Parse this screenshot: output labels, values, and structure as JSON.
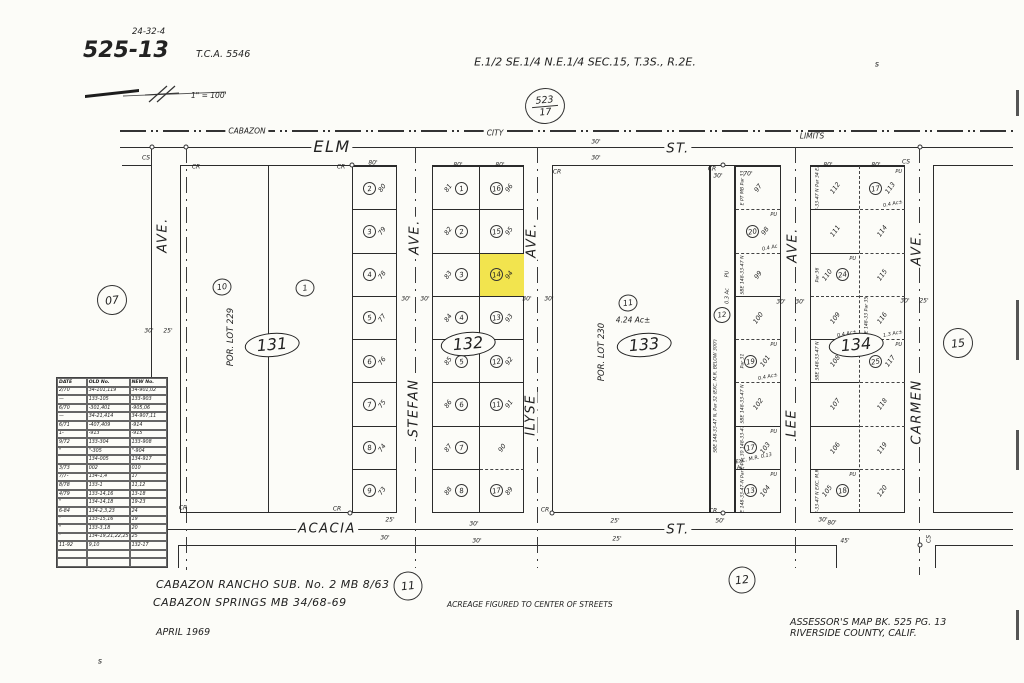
{
  "page": {
    "map_ref": "24-32-4",
    "book_page": "525-13",
    "tca": "T.C.A. 5546",
    "title": "E.1/2 SE.1/4 N.E.1/4  SEC.15, T.3S., R.2E.",
    "scale_label": "1\" = 100'",
    "adjacent_ref_top": {
      "num": "523",
      "den": "17"
    }
  },
  "city_limits": {
    "left": "CABAZON",
    "mid": "CITY",
    "right": "LIMITS"
  },
  "streets": {
    "elm": {
      "name": "ELM",
      "suffix": "ST."
    },
    "acacia": {
      "name": "ACACIA",
      "suffix": "ST."
    },
    "bonita": {
      "name": "BONITA",
      "suffix": "AVE."
    },
    "stefan": {
      "name": "STEFAN",
      "suffix": "AVE."
    },
    "ilyse": {
      "name": "ILYSE",
      "suffix": "AVE."
    },
    "lee": {
      "name": "LEE",
      "suffix": "AVE."
    },
    "carmen": {
      "name": "CARMEN",
      "suffix": "AVE."
    }
  },
  "adjacent_pages": [
    {
      "label": "07",
      "x": 112,
      "y": 300,
      "d": 30
    },
    {
      "label": "15",
      "x": 958,
      "y": 343,
      "d": 30
    },
    {
      "label": "11",
      "x": 408,
      "y": 586,
      "d": 29
    },
    {
      "label": "12",
      "x": 742,
      "y": 580,
      "d": 27
    }
  ],
  "blocks": {
    "b131": {
      "label": "131",
      "por": "POR. LOT 229",
      "main": [
        {
          "circle": "10"
        },
        {
          "circle": "1"
        }
      ],
      "strip": [
        {
          "circle": "2",
          "lot": "80"
        },
        {
          "circle": "3",
          "lot": "79"
        },
        {
          "circle": "4",
          "lot": "78"
        },
        {
          "circle": "5",
          "lot": "77"
        },
        {
          "circle": "6",
          "lot": "76"
        },
        {
          "circle": "7",
          "lot": "75"
        },
        {
          "circle": "8",
          "lot": "74"
        },
        {
          "circle": "9",
          "lot": "73"
        }
      ]
    },
    "b132": {
      "label": "132",
      "west": [
        {
          "circle": "1",
          "lot": "81"
        },
        {
          "circle": "2",
          "lot": "82"
        },
        {
          "circle": "3",
          "lot": "83"
        },
        {
          "circle": "4",
          "lot": "84"
        },
        {
          "circle": "5",
          "lot": "85"
        },
        {
          "circle": "6",
          "lot": "86"
        },
        {
          "circle": "7",
          "lot": "87"
        },
        {
          "circle": "8",
          "lot": "88"
        }
      ],
      "east": [
        {
          "circle": "16",
          "lot": "96"
        },
        {
          "circle": "15",
          "lot": "95"
        },
        {
          "circle": "14",
          "lot": "94",
          "highlight": true
        },
        {
          "circle": "13",
          "lot": "93"
        },
        {
          "circle": "12",
          "lot": "92"
        },
        {
          "circle": "11",
          "lot": "91"
        },
        {
          "lot": "90"
        },
        {
          "circle": "17",
          "lot": "89",
          "dash_top": true
        }
      ]
    },
    "b133": {
      "label": "133",
      "por": "POR. LOT 230",
      "circle": "11",
      "acreage": "4.24 Ac±",
      "strip": {
        "circle": "12",
        "pu": "PU",
        "ac": "0.3 Ac",
        "note": "SBE 148-33-47 N, Par 32 (EXC. M.R. BELOW 300')"
      },
      "lee_col": [
        {
          "lot": "97",
          "note": "E PT MB Par 33"
        },
        {
          "circle": "20",
          "lot": "98",
          "pu": "PU",
          "ac": "0.4 Ac",
          "dash_top": true
        },
        {
          "lot": "99",
          "note": "SBE 148-33-47 N",
          "dash_top": true
        },
        {
          "lot": "100"
        },
        {
          "circle": "19",
          "lot": "101",
          "pu": "PU",
          "ac": "0.4 Ac±",
          "note": "Par 31",
          "dash_top": true
        },
        {
          "lot": "102",
          "note": "SBE 148-33-47 N",
          "dash_top": true
        },
        {
          "circle": "17",
          "lot": "103",
          "pu": "PU",
          "note": "SBE Par 30 148-33-47 N",
          "ac": "EXC. M.R. 0.13 Ac."
        },
        {
          "circle": "13",
          "lot": "104",
          "pu": "PU",
          "note": "SBE 148-33-47-N Par 29"
        }
      ]
    },
    "b134": {
      "label": "134",
      "west": [
        {
          "lot": "112",
          "note": "SBE 148-33-47 N Par 34 EXC. M.R."
        },
        {
          "lot": "111"
        },
        {
          "circle": "24",
          "lot": "110",
          "pu": "PU",
          "note": "Par 36"
        },
        {
          "lot": "109",
          "ac": "0.4 Ac±",
          "dash_top": true
        },
        {
          "lot": "108",
          "note": "SBE 148-33-47 N"
        },
        {
          "lot": "107"
        },
        {
          "lot": "106"
        },
        {
          "circle": "18",
          "lot": "105",
          "pu": "PU",
          "note": "SBE 148-33-47 N EXC. M.R. Par 28"
        }
      ],
      "east": [
        {
          "circle": "17",
          "lot": "113",
          "pu": "PU",
          "ac": "0.4 Ac±"
        },
        {
          "lot": "114",
          "dash_top": true
        },
        {
          "lot": "115",
          "dash_top": true
        },
        {
          "lot": "116",
          "ac": "1.3 Ac±",
          "note": "SBE 148-33 Par 35",
          "dash_top": true
        },
        {
          "circle": "25",
          "lot": "117",
          "pu": "PU",
          "dash_top": true
        },
        {
          "lot": "118",
          "dash_top": true
        },
        {
          "lot": "119",
          "dash_top": true
        },
        {
          "lot": "120",
          "dash_top": true
        }
      ]
    }
  },
  "revision_table": {
    "headers": [
      "DATE",
      "OLD No.",
      "NEW No."
    ],
    "rows": [
      [
        "2/70",
        "34-101,119",
        "34-901,02"
      ],
      [
        "—",
        "133-105",
        "133-903"
      ],
      [
        "6/70",
        "-301,401",
        "-905,06"
      ],
      [
        "—",
        "34-21,414",
        "34-907,11"
      ],
      [
        "6/71",
        "-407,409",
        "-914"
      ],
      [
        "1-",
        "-913",
        "-915"
      ],
      [
        "9/72",
        "133-304",
        "133-908"
      ],
      [
        "\"",
        "\"-305",
        "\"-904"
      ],
      [
        "",
        "134-005",
        "134-917"
      ],
      [
        "3/73",
        "002",
        "010"
      ],
      [
        "7/7-",
        "134-1,4",
        "17"
      ],
      [
        "8/78",
        "133-1",
        "11,12"
      ],
      [
        "4/79",
        "133-14,16",
        "13-18"
      ],
      [
        "\"",
        "134-14,18",
        "19-23"
      ],
      [
        "6-84",
        "134-2,3,23",
        "24"
      ],
      [
        "\"",
        "133-15,16",
        "19"
      ],
      [
        "\"",
        "133-3,18",
        "20"
      ],
      [
        "\"",
        "134-19,21,22,25",
        "25"
      ],
      [
        "11-92",
        "9,10",
        "132-17"
      ],
      [
        "",
        "",
        ""
      ],
      [
        "",
        "",
        ""
      ]
    ]
  },
  "footer": {
    "sub_note1": "CABAZON  RANCHO  SUB.  No. 2  MB 8/63",
    "sub_note2": "CABAZON  SPRINGS  MB 34/68-69",
    "date": "APRIL  1969",
    "acreage_note": "ACREAGE   FIGURED   TO   CENTER   OF   STREETS",
    "assessor_line1": "ASSESSOR'S   MAP   BK. 525   PG. 13",
    "assessor_line2": "RIVERSIDE    COUNTY,   CALIF."
  },
  "corner_markers": [
    {
      "t": "CS",
      "x": 146,
      "y": 158
    },
    {
      "t": "CR",
      "x": 196,
      "y": 167
    },
    {
      "t": "CR",
      "x": 341,
      "y": 167
    },
    {
      "t": "CR",
      "x": 557,
      "y": 172
    },
    {
      "t": "CR",
      "x": 712,
      "y": 169
    },
    {
      "t": "CS",
      "x": 906,
      "y": 162
    },
    {
      "t": "CR",
      "x": 183,
      "y": 508
    },
    {
      "t": "CR",
      "x": 337,
      "y": 509
    },
    {
      "t": "CR",
      "x": 545,
      "y": 510
    },
    {
      "t": "CR",
      "x": 713,
      "y": 511
    },
    {
      "t": "CS",
      "x": 929,
      "y": 539,
      "rot": -90
    }
  ],
  "dims": [
    {
      "t": "30'",
      "x": 596,
      "y": 142
    },
    {
      "t": "30'",
      "x": 596,
      "y": 158
    },
    {
      "t": "80'",
      "x": 373,
      "y": 163
    },
    {
      "t": "80'",
      "x": 458,
      "y": 165
    },
    {
      "t": "80'",
      "x": 500,
      "y": 165
    },
    {
      "t": "80'",
      "x": 828,
      "y": 165
    },
    {
      "t": "80'",
      "x": 876,
      "y": 165
    },
    {
      "t": "30'",
      "x": 149,
      "y": 331
    },
    {
      "t": "25'",
      "x": 168,
      "y": 331
    },
    {
      "t": "30'",
      "x": 406,
      "y": 299
    },
    {
      "t": "30'",
      "x": 425,
      "y": 299
    },
    {
      "t": "30'",
      "x": 527,
      "y": 299
    },
    {
      "t": "30'",
      "x": 549,
      "y": 299
    },
    {
      "t": "30'",
      "x": 781,
      "y": 302
    },
    {
      "t": "30'",
      "x": 800,
      "y": 302
    },
    {
      "t": "30'",
      "x": 905,
      "y": 301
    },
    {
      "t": "25'",
      "x": 924,
      "y": 301
    },
    {
      "t": "25'",
      "x": 390,
      "y": 520
    },
    {
      "t": "30'",
      "x": 385,
      "y": 538
    },
    {
      "t": "30'",
      "x": 474,
      "y": 524
    },
    {
      "t": "30'",
      "x": 477,
      "y": 541
    },
    {
      "t": "25'",
      "x": 615,
      "y": 521
    },
    {
      "t": "25'",
      "x": 617,
      "y": 539
    },
    {
      "t": "30'",
      "x": 823,
      "y": 520
    },
    {
      "t": "45'",
      "x": 845,
      "y": 541
    },
    {
      "t": "50'",
      "x": 720,
      "y": 521
    },
    {
      "t": "80'",
      "x": 832,
      "y": 523
    },
    {
      "t": "30'",
      "x": 718,
      "y": 176
    },
    {
      "t": "70'",
      "x": 748,
      "y": 174
    }
  ],
  "tick_marks": [
    {
      "t": "s",
      "x": 877,
      "y": 64
    },
    {
      "t": "s",
      "x": 100,
      "y": 661
    }
  ],
  "colors": {
    "highlight": "#f2e44e",
    "ink": "#2b2b2b",
    "paper": "#fcfcf8"
  }
}
